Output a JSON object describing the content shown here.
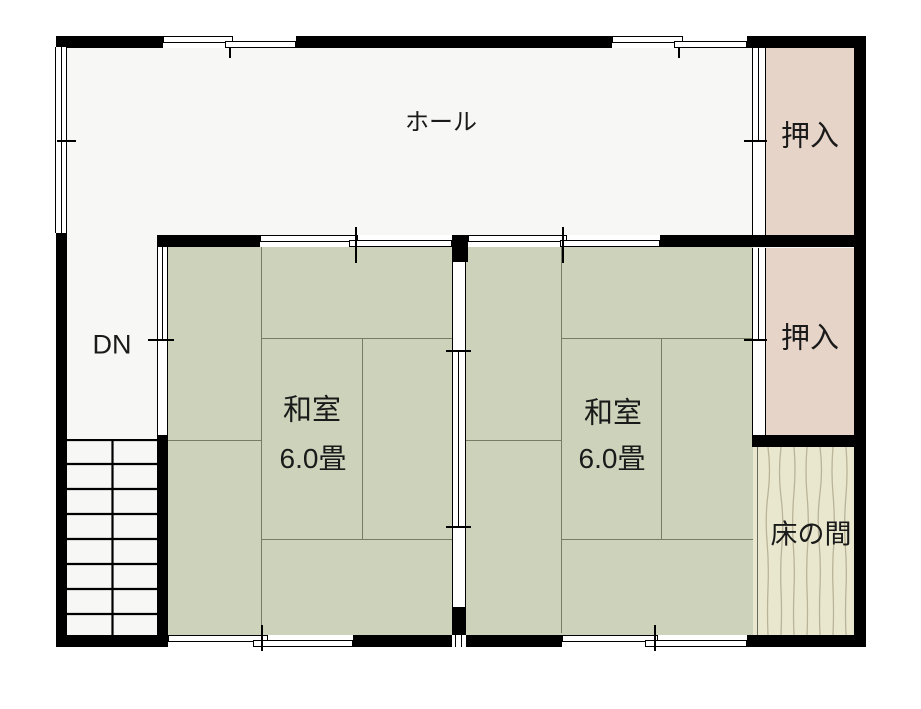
{
  "rooms": {
    "hall": {
      "label": "ホール"
    },
    "stairs": {
      "label": "DN"
    },
    "japanese_room_1": {
      "label": "和室",
      "size": "6.0畳"
    },
    "japanese_room_2": {
      "label": "和室",
      "size": "6.0畳"
    },
    "closet_top": {
      "label": "押入"
    },
    "closet_middle": {
      "label": "押入"
    },
    "tokonoma": {
      "label": "床の間"
    }
  },
  "colors": {
    "background": "#ffffff",
    "wall": "#000000",
    "hall_floor": "#f7f7f5",
    "tatami": "#cdd2bb",
    "tatami_line": "#777c67",
    "closet": "#e7d4c8",
    "tokonoma_floor": "#e9e8cf",
    "tokonoma_grain": "#b9b398",
    "text": "#1a1a1a"
  }
}
